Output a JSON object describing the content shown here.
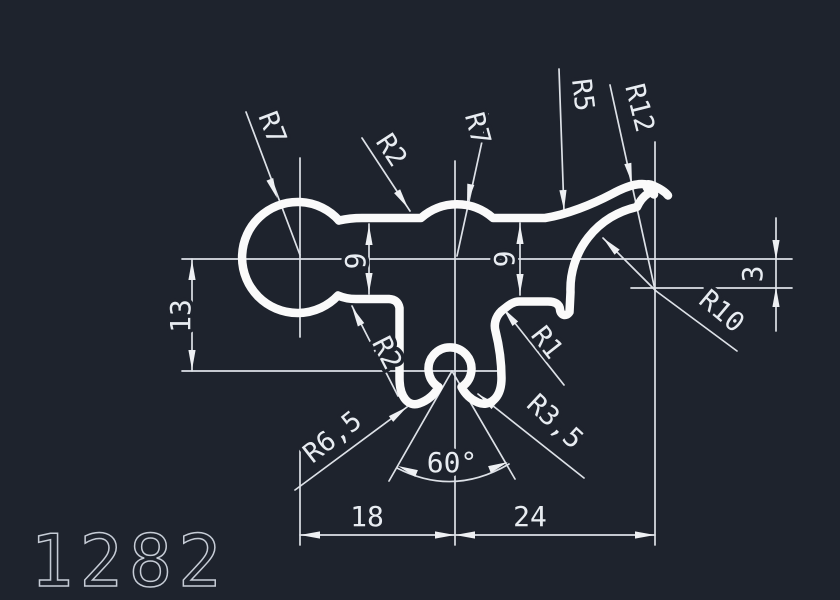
{
  "drawing": {
    "background_color": "#1e232d",
    "profile_color": "#fafafa",
    "dimension_color": "#dde1e7",
    "drawing_number_color": "#c6ccd6"
  },
  "labels": {
    "r7_left": "R7",
    "r2_top": "R2",
    "r7_center": "R7",
    "r5": "R5",
    "r12": "R12",
    "r10": "R10",
    "r2_bottom": "R2",
    "r1": "R1",
    "r6_5": "R6,5",
    "r3_5": "R3,5",
    "dim_13": "13",
    "dim_9_left": "9",
    "dim_9_right": "9",
    "dim_3": "3",
    "dim_18": "18",
    "dim_24": "24",
    "angle_60": "60°",
    "drawing_number": "1282"
  }
}
